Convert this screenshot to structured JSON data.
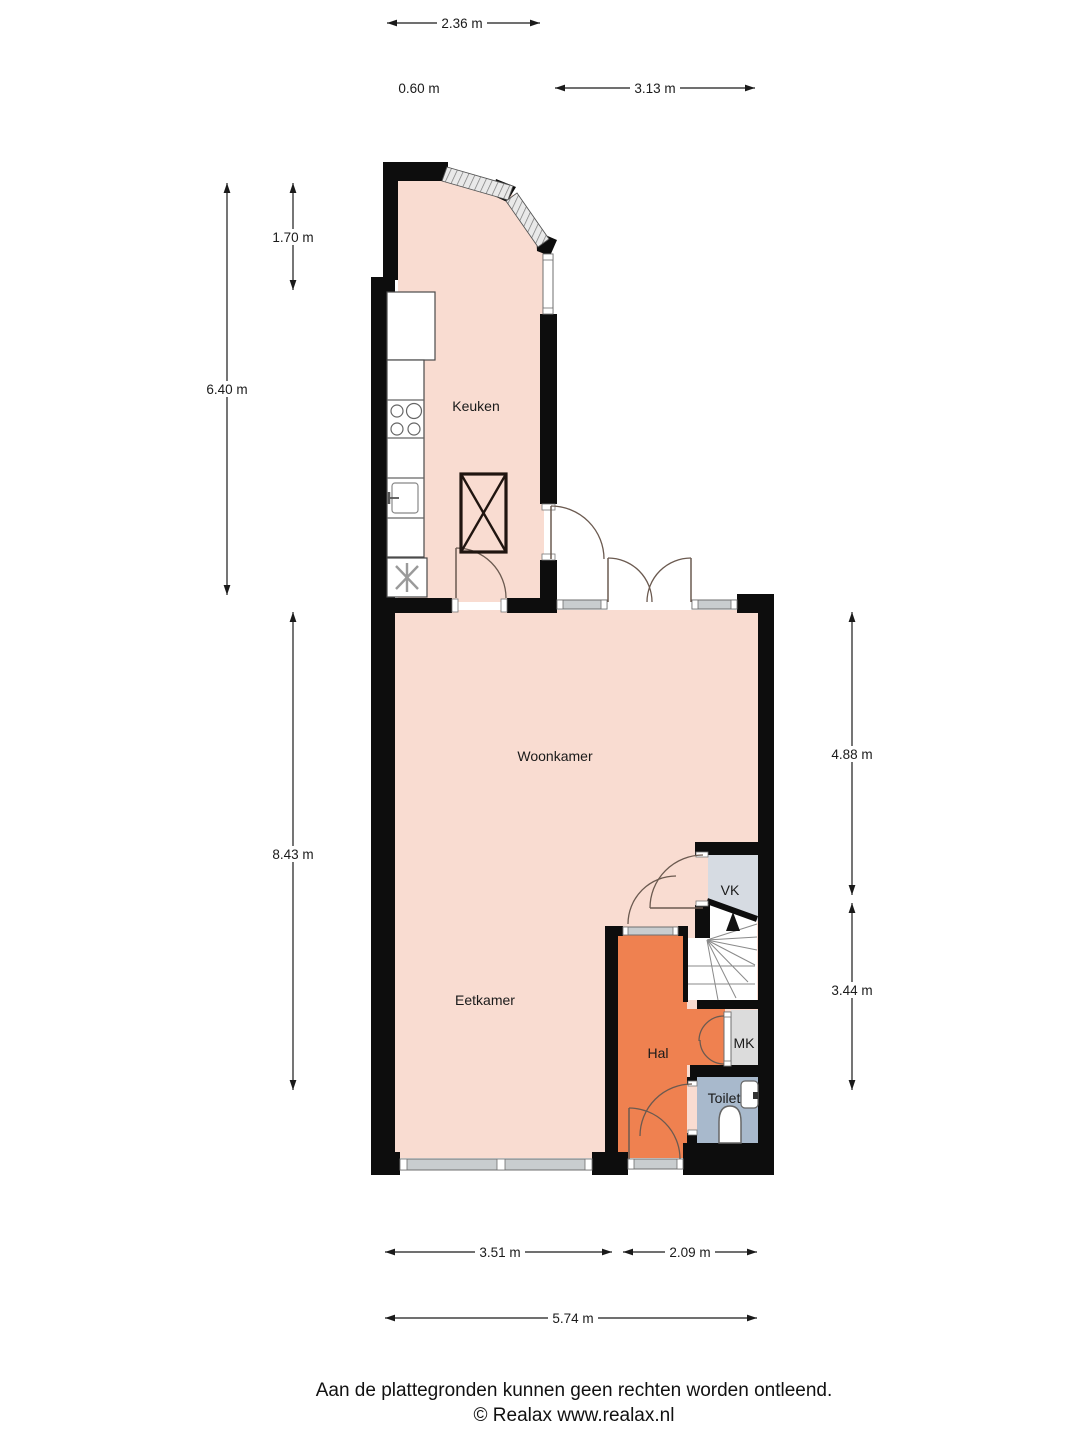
{
  "footer": {
    "line1": "Aan de plattegronden kunnen geen rechten worden ontleend.",
    "line2": "© Realax www.realax.nl"
  },
  "rooms": {
    "keuken": {
      "label": "Keuken",
      "color": "#f9dcd1"
    },
    "woonkamer": {
      "label": "Woonkamer",
      "color": "#f9dcd1"
    },
    "eetkamer": {
      "label": "Eetkamer",
      "color": "#f9dcd1"
    },
    "hal": {
      "label": "Hal",
      "color": "#ef8150"
    },
    "vk": {
      "label": "VK",
      "color": "#d6dbe2"
    },
    "mk": {
      "label": "MK",
      "color": "#dcdcdc"
    },
    "toilet": {
      "label": "Toilet",
      "color": "#a8b9cc"
    }
  },
  "dimensions": {
    "kitchen_width_top": {
      "label": "2.36 m"
    },
    "wall_offset": {
      "label": "0.60 m"
    },
    "terrace_width": {
      "label": "3.13 m"
    },
    "kitchen_top_height": {
      "label": "1.70 m"
    },
    "kitchen_left_height": {
      "label": "6.40 m"
    },
    "living_left_height": {
      "label": "8.43 m"
    },
    "living_right_height": {
      "label": "4.88 m"
    },
    "hall_right_height": {
      "label": "3.44 m"
    },
    "eetkamer_width": {
      "label": "3.51 m"
    },
    "hal_width": {
      "label": "2.09 m"
    },
    "total_width": {
      "label": "5.74 m"
    }
  },
  "colors": {
    "wall": "#0d0d0d",
    "window_fill": "#c9cdcf",
    "window_stroke": "#6f6f6f",
    "door_arc": "#6b5a50",
    "dimension_text": "#1a1a1a",
    "stair_tread": "#8a8a8a"
  }
}
